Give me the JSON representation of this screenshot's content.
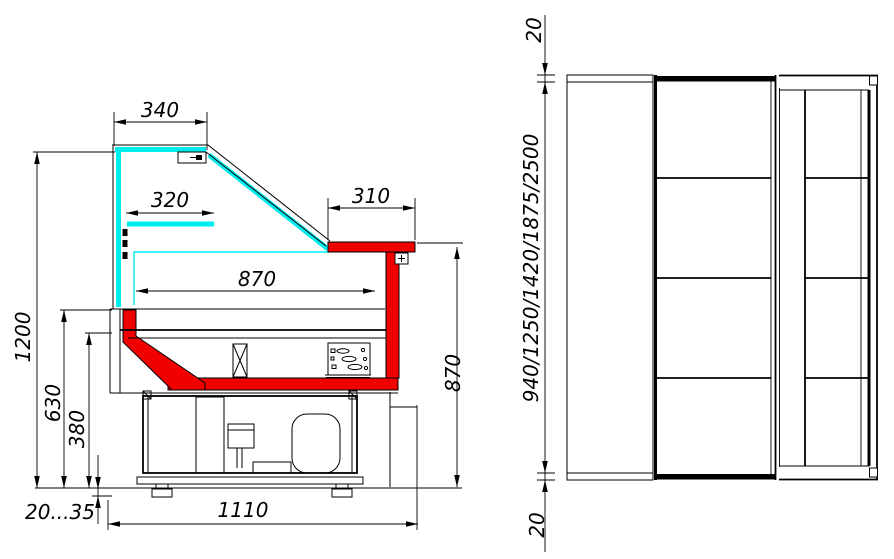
{
  "drawing": {
    "description": "Refrigerated serve-over display counter: side cross-section and plan view",
    "colors": {
      "glass": "#00eded",
      "deck_highlight": "#f20000",
      "line": "#000000",
      "background": "#ffffff"
    }
  },
  "side_view": {
    "dim_340": "340",
    "dim_320": "320",
    "dim_310": "310",
    "dim_870_width": "870",
    "dim_1200": "1200",
    "dim_630": "630",
    "dim_380": "380",
    "dim_870_height": "870",
    "dim_foot_adjust": "20...35",
    "dim_1110": "1110"
  },
  "plan_view": {
    "dim_20_top": "20",
    "dim_lengths": "940/1250/1420/1875/2500",
    "dim_20_bottom": "20"
  }
}
